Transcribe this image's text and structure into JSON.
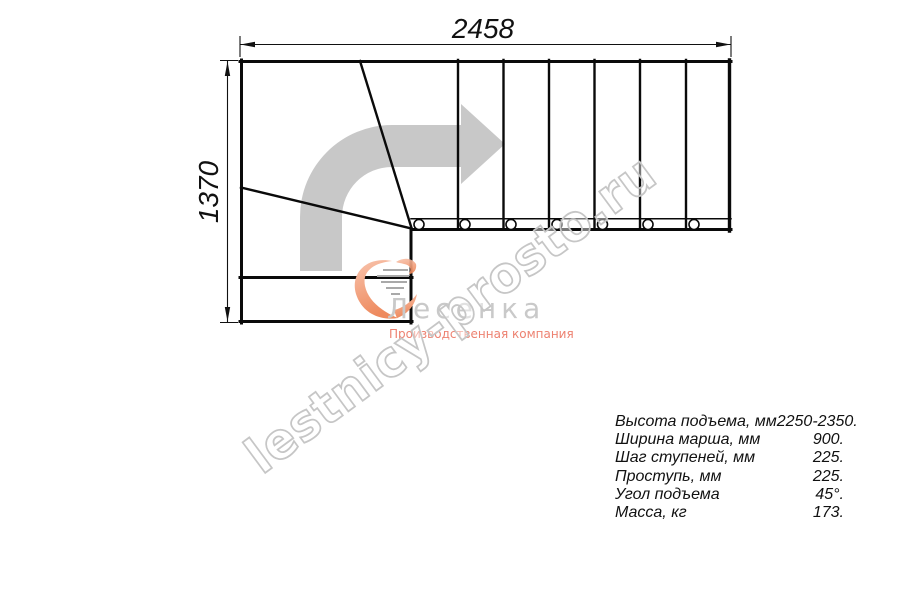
{
  "drawing": {
    "dimension_top": "2458",
    "dimension_left": "1370"
  },
  "logo": {
    "name": "Лесенка",
    "tagline": "Производственная компания"
  },
  "watermark": {
    "text": "lestnicy-prosto.ru"
  },
  "specs": {
    "rows": [
      {
        "label": "Высота подъема, мм",
        "value": "2250-2350."
      },
      {
        "label": "Ширина марша, мм",
        "value": "900."
      },
      {
        "label": "Шаг ступеней, мм",
        "value": "225."
      },
      {
        "label": "Проступь, мм",
        "value": "225."
      },
      {
        "label": "Угол подъема",
        "value": "45°."
      },
      {
        "label": "Масса, кг",
        "value": "173."
      }
    ]
  },
  "colors": {
    "line": "#0a0a0a",
    "direction_arrow": "#c8c8c8",
    "watermark_outline": "#c6c6c6",
    "logo_accent": "#f09168",
    "logo_name": "#c9c9c9",
    "logo_tagline": "#ed8170"
  }
}
